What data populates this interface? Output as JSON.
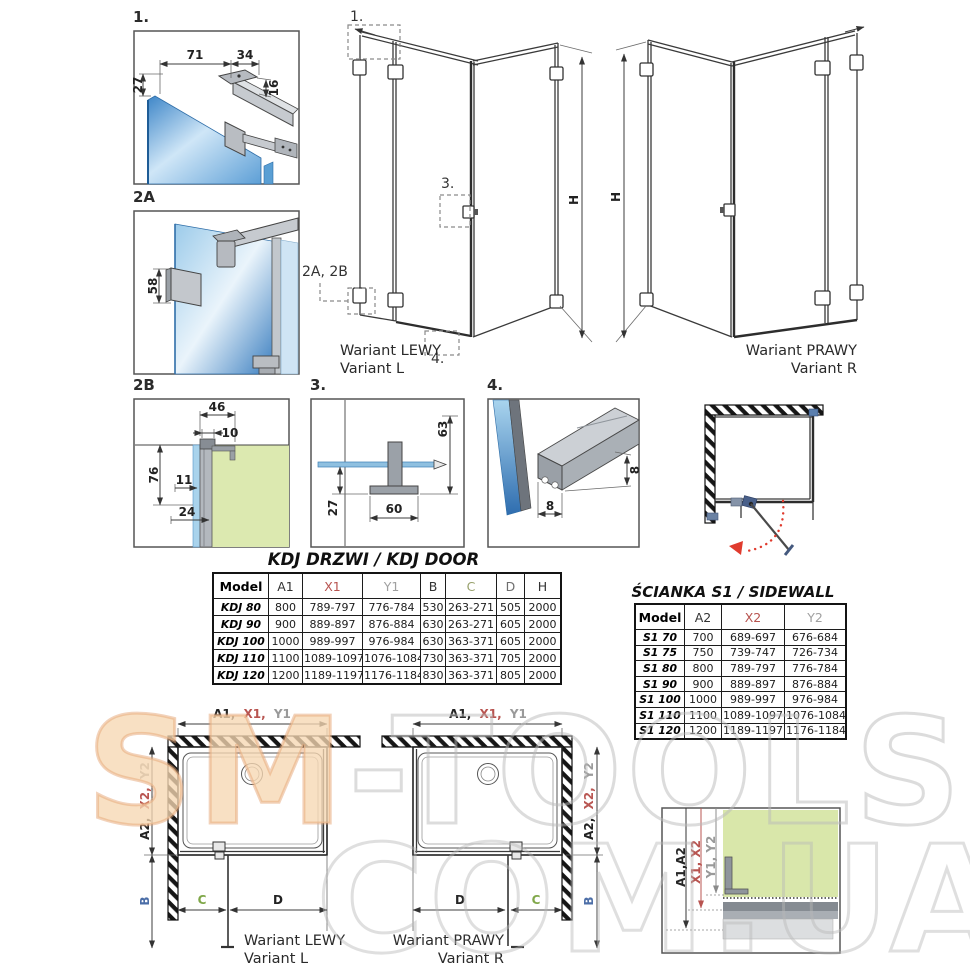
{
  "colors": {
    "accent_red": "#b85450",
    "label_gray": "#9a9a9a",
    "label_green": "#7fa748",
    "label_blue": "#4a6da7",
    "glass_blue": "#3e86c8",
    "wall_green": "#d9e7aa",
    "profile_gray": "#b9bdc2",
    "arc_red": "#e03b2e",
    "watermark_orange": "#e6a676",
    "watermark_gray": "#bebebe"
  },
  "details": {
    "d1": {
      "label": "1.",
      "dim_71": "71",
      "dim_34": "34",
      "dim_27": "27",
      "dim_16": "16"
    },
    "d2a": {
      "label": "2A",
      "dim_58": "58"
    },
    "d2b": {
      "label": "2B",
      "dim_46": "46",
      "dim_10": "10",
      "dim_76": "76",
      "dim_11": "11",
      "dim_24": "24"
    },
    "d3": {
      "label": "3.",
      "dim_63": "63",
      "dim_27": "27",
      "dim_60": "60"
    },
    "d4": {
      "label": "4.",
      "dim_h8": "8",
      "dim_w8": "8"
    }
  },
  "views": {
    "left": {
      "marker_1": "1.",
      "marker_3": "3.",
      "marker_2": "2A, 2B",
      "marker_4": "4.",
      "height_label": "H",
      "caption_pl": "Wariant LEWY",
      "caption_en": "Variant L"
    },
    "right": {
      "height_label": "H",
      "caption_pl": "Wariant PRAWY",
      "caption_en": "Variant R"
    }
  },
  "kdj_table": {
    "title": "KDJ DRZWI / KDJ DOOR",
    "headers": [
      "Model",
      "A1",
      "X1",
      "Y1",
      "B",
      "C",
      "D",
      "H"
    ],
    "header_colors": [
      "#000000",
      "#333333",
      "#b85450",
      "#a0a0a0",
      "#333333",
      "#97a06b",
      "#6e6e6e",
      "#333333"
    ],
    "rows": [
      [
        "KDJ 80",
        "800",
        "789-797",
        "776-784",
        "530",
        "263-271",
        "505",
        "2000"
      ],
      [
        "KDJ 90",
        "900",
        "889-897",
        "876-884",
        "630",
        "263-271",
        "605",
        "2000"
      ],
      [
        "KDJ 100",
        "1000",
        "989-997",
        "976-984",
        "630",
        "363-371",
        "605",
        "2000"
      ],
      [
        "KDJ 110",
        "1100",
        "1089-1097",
        "1076-1084",
        "730",
        "363-371",
        "705",
        "2000"
      ],
      [
        "KDJ 120",
        "1200",
        "1189-1197",
        "1176-1184",
        "830",
        "363-371",
        "805",
        "2000"
      ]
    ]
  },
  "s1_table": {
    "title": "ŚCIANKA S1 / SIDEWALL S1",
    "headers": [
      "Model",
      "A2",
      "X2",
      "Y2"
    ],
    "header_colors": [
      "#000000",
      "#333333",
      "#b85450",
      "#a0a0a0"
    ],
    "rows": [
      [
        "S1 70",
        "700",
        "689-697",
        "676-684"
      ],
      [
        "S1 75",
        "750",
        "739-747",
        "726-734"
      ],
      [
        "S1 80",
        "800",
        "789-797",
        "776-784"
      ],
      [
        "S1 90",
        "900",
        "889-897",
        "876-884"
      ],
      [
        "S1 100",
        "1000",
        "989-997",
        "976-984"
      ],
      [
        "S1 110",
        "1100",
        "1089-1097",
        "1076-1084"
      ],
      [
        "S1 120",
        "1200",
        "1189-1197",
        "1176-1184"
      ]
    ]
  },
  "plans": {
    "left": {
      "top_a1": "A1,",
      "top_x1": "X1,",
      "top_y1": "Y1",
      "side_a2": "A2,",
      "side_x2": "X2,",
      "side_y2": "Y2",
      "dim_b": "B",
      "dim_c": "C",
      "dim_d": "D",
      "caption_pl": "Wariant LEWY",
      "caption_en": "Variant L"
    },
    "right": {
      "top_a1": "A1,",
      "top_x1": "X1,",
      "top_y1": "Y1",
      "side_a2": "A2,",
      "side_x2": "X2,",
      "side_y2": "Y2",
      "dim_b": "B",
      "dim_c": "C",
      "dim_d": "D",
      "caption_pl": "Wariant PRAWY",
      "caption_en": "Variant R"
    }
  },
  "wall_section": {
    "label_a": "A1,A2",
    "label_x": "X1, X2",
    "label_y": "Y1, Y2"
  },
  "watermark": {
    "part1": "SM",
    "part2": "-TOOLS",
    "line2": "COM.UA"
  }
}
